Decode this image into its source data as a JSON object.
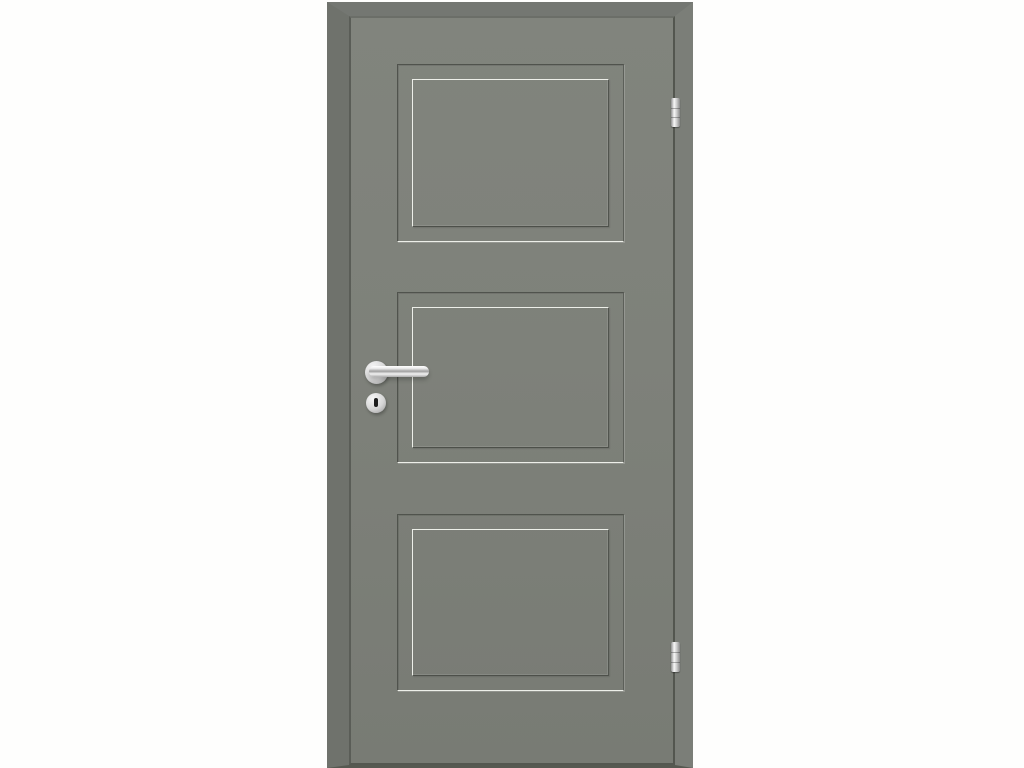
{
  "scene": {
    "type": "product-photo",
    "subject": "Grey lacquered interior door with three recessed rectangular panels, stainless-steel lever handle with round rosette, round keyhole escutcheon, and two hinges on the right edge",
    "background_color": "#fefefd"
  },
  "door": {
    "panel_count": 3,
    "colors": {
      "face": "#7e817a",
      "face_top": "#81847d",
      "face_bottom": "#787b74",
      "edge_left": "#6f726c",
      "edge_top": "#747772",
      "edge_right": "#7b7e78",
      "seam_dark": "#565951",
      "groove_dark": "#50534d",
      "groove_mid": "#5c5f59",
      "groove_light": "#edefe9"
    },
    "panels": [
      {
        "name": "top-panel"
      },
      {
        "name": "middle-panel"
      },
      {
        "name": "bottom-panel"
      }
    ]
  },
  "hardware": {
    "handle": {
      "type": "lever-handle",
      "finish": "stainless-steel"
    },
    "keyhole": {
      "type": "round-escutcheon"
    },
    "hinge_count": 2,
    "hinges": [
      {
        "name": "top-hinge"
      },
      {
        "name": "bottom-hinge"
      }
    ],
    "colors": {
      "metal": "#d6d6d6",
      "metal_highlight": "#f7f7f7",
      "metal_shadow": "#9c9c9c",
      "keyhole_slot": "#1f1f1f"
    }
  }
}
